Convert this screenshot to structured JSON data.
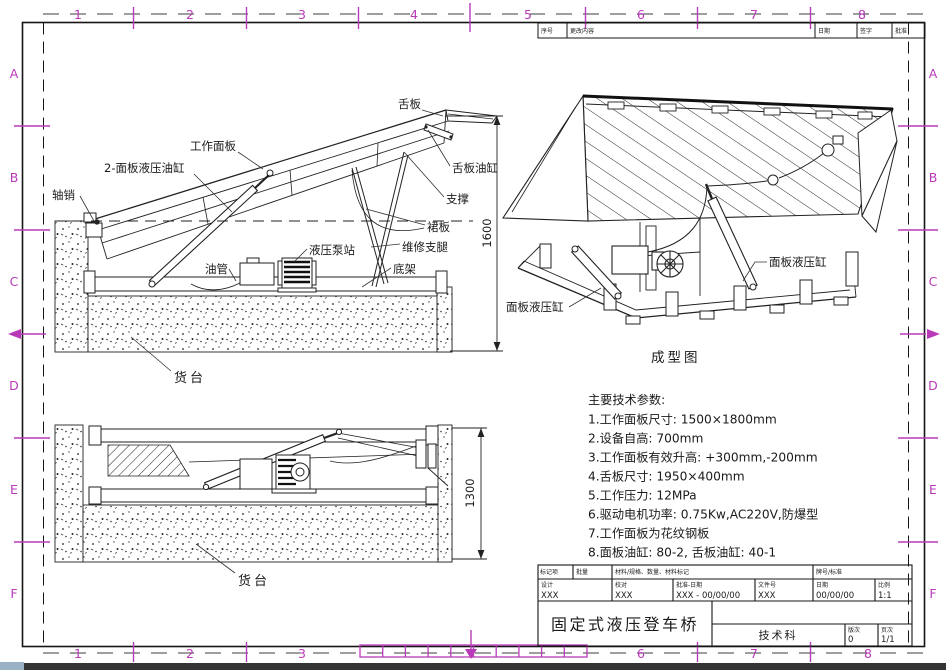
{
  "frame": {
    "top_numbers": [
      "1",
      "2",
      "3",
      "4",
      "5",
      "6",
      "7",
      "8"
    ],
    "bottom_numbers": [
      "1",
      "2",
      "3",
      "6",
      "7",
      "8"
    ],
    "left_letters": [
      "A",
      "B",
      "C",
      "D",
      "E",
      "F"
    ],
    "right_letters": [
      "A",
      "B",
      "C",
      "D",
      "E",
      "F"
    ],
    "accent_color": "#b93ab9"
  },
  "revision_strip": {
    "c1": "序号",
    "c2": "更改内容",
    "c3": "日期",
    "c4": "签字",
    "c5": "批准"
  },
  "view_raised": {
    "labels": {
      "axle_pin": "轴销",
      "panel_cylinders": "2-面板液压油缸",
      "work_panel": "工作面板",
      "lip": "舌板",
      "lip_cylinder": "舌板油缸",
      "support": "支撑",
      "skirt": "裙板",
      "maintenance_leg": "维修支腿",
      "pump_station": "液压泵站",
      "oil_pipe": "油管",
      "base_frame": "底架",
      "dock": "货台"
    },
    "dimension": "1600"
  },
  "view_lowered": {
    "labels": {
      "dock": "货台"
    },
    "dimension": "1300"
  },
  "view_iso": {
    "labels": {
      "panel_cylinder_left": "面板液压缸",
      "panel_cylinder_right": "面板液压缸"
    },
    "caption": "成型图"
  },
  "tech_params": {
    "title": "主要技术参数:",
    "items": [
      "1.工作面板尺寸: 1500×1800mm",
      "2.设备自高: 700mm",
      "3.工作面板有效升高: +300mm,-200mm",
      "4.舌板尺寸: 1950×400mm",
      "5.工作压力: 12MPa",
      "6.驱动电机功率: 0.75Kw,AC220V,防爆型",
      "7.工作面板为花纹钢板",
      "8.面板油缸: 80-2, 舌板油缸: 40-1"
    ]
  },
  "title_block": {
    "headers": {
      "h1": "标记项",
      "h2": "批量",
      "h3": "材料/规格、数量、材料标记",
      "h4": "牌号/标准"
    },
    "fields": [
      {
        "label": "设计",
        "value": "XXX"
      },
      {
        "label": "校对",
        "value": "XXX"
      },
      {
        "label": "批准-日期",
        "value": "XXX - 00/00/00"
      },
      {
        "label": "文件号",
        "value": "XXX"
      },
      {
        "label": "日期",
        "value": "00/00/00"
      },
      {
        "label": "比例",
        "value": "1:1"
      }
    ],
    "drawing_title": "固定式液压登车桥",
    "department": "技术科",
    "version_label": "版次",
    "version": "0",
    "sheet_label": "页次",
    "sheet": "1/1"
  }
}
